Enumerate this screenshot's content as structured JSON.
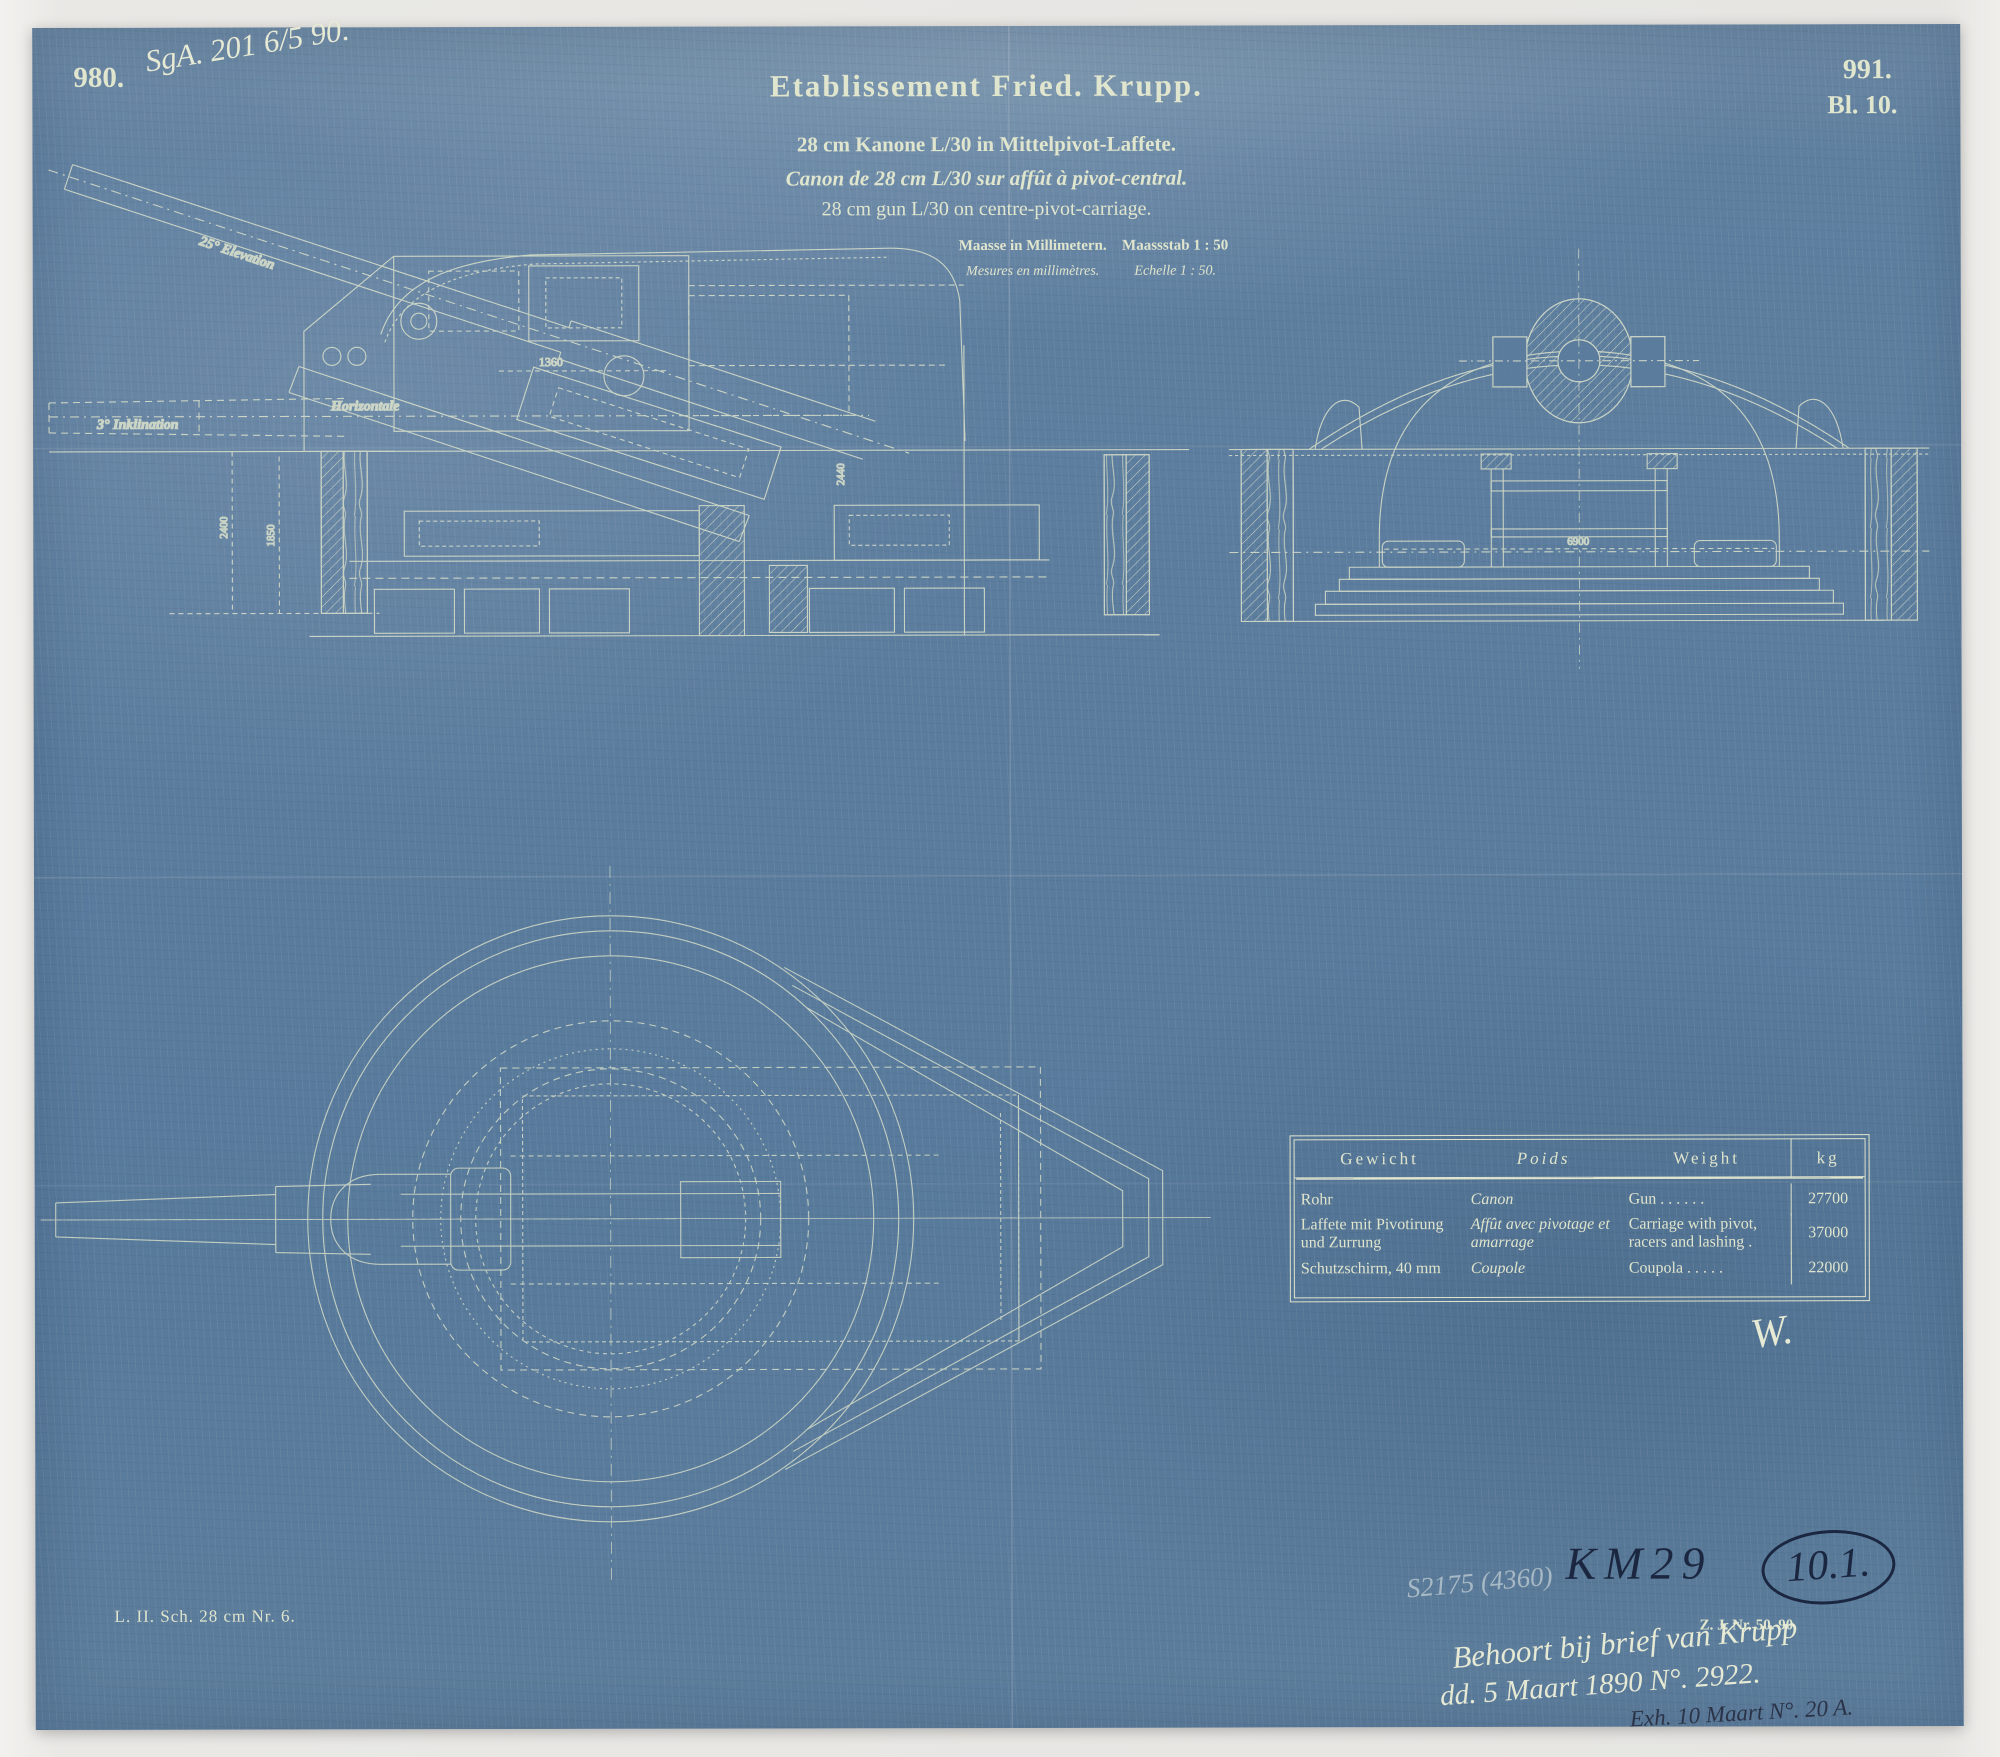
{
  "colors": {
    "paper_blue": "#5b7c9d",
    "line_cream": "#dfe4cd",
    "ink_dark": "#1b2740",
    "pencil": "#a7b9c4",
    "photo_bg": "#e9e8e5"
  },
  "header": {
    "plate_number_left": "980.",
    "registry_note": "SgA. 201 6/5 90.",
    "plate_number_right": "991.",
    "sheet_number": "Bl. 10.",
    "company": "Etablissement Fried. Krupp.",
    "subtitle_de": "28 cm Kanone L/30 in Mittelpivot-Laffete.",
    "subtitle_fr": "Canon de 28 cm L/30 sur affût à pivot-central.",
    "subtitle_en": "28 cm gun L/30 on centre-pivot-carriage.",
    "units_de": "Maasse in Millimetern.",
    "scale_de": "Maassstab 1 : 50",
    "units_fr": "Mesures en millimètres.",
    "scale_fr": "Echelle 1 : 50."
  },
  "side_view": {
    "label_elevation": "25° Elevation",
    "label_horizontal": "Horizontale",
    "label_inclination": "3° Inklination",
    "dim_a": "1360",
    "dim_b": "2440",
    "dim_c": "2400",
    "dim_d": "1850"
  },
  "cross_section": {
    "dim_width": "6900"
  },
  "weight_table": {
    "col_de": "Gewicht",
    "col_fr": "Poids",
    "col_en": "Weight",
    "col_unit": "kg",
    "rows": [
      {
        "de": "Rohr",
        "fr": "Canon",
        "en": "Gun  .  .  .  .  .  .",
        "kg": "27700"
      },
      {
        "de": "Laffete mit Pivotirung und Zurrung",
        "fr": "Affût avec pivotage et amarrage",
        "en": "Carriage with pivot, racers and lashing .",
        "kg": "37000"
      },
      {
        "de": "Schutzschirm, 40 mm",
        "fr": "Coupole",
        "en": "Coupola  .  .  .  .  .",
        "kg": "22000"
      }
    ]
  },
  "footer": {
    "plate_code": "L. II. Sch. 28 cm Nr. 6.",
    "printed_ref": "Z. J. Nr. 50. 90.",
    "monogram": "W."
  },
  "annotations": {
    "pencil_note": "S2175 (4360)",
    "inventory_code": "KM29",
    "circled_number": "10.1.",
    "hand_line1": "Behoort bij brief van Krupp",
    "hand_line2": "dd. 5 Maart 1890 N°. 2922.",
    "hand_line3": "Exh. 10 Maart N°. 20 A."
  }
}
